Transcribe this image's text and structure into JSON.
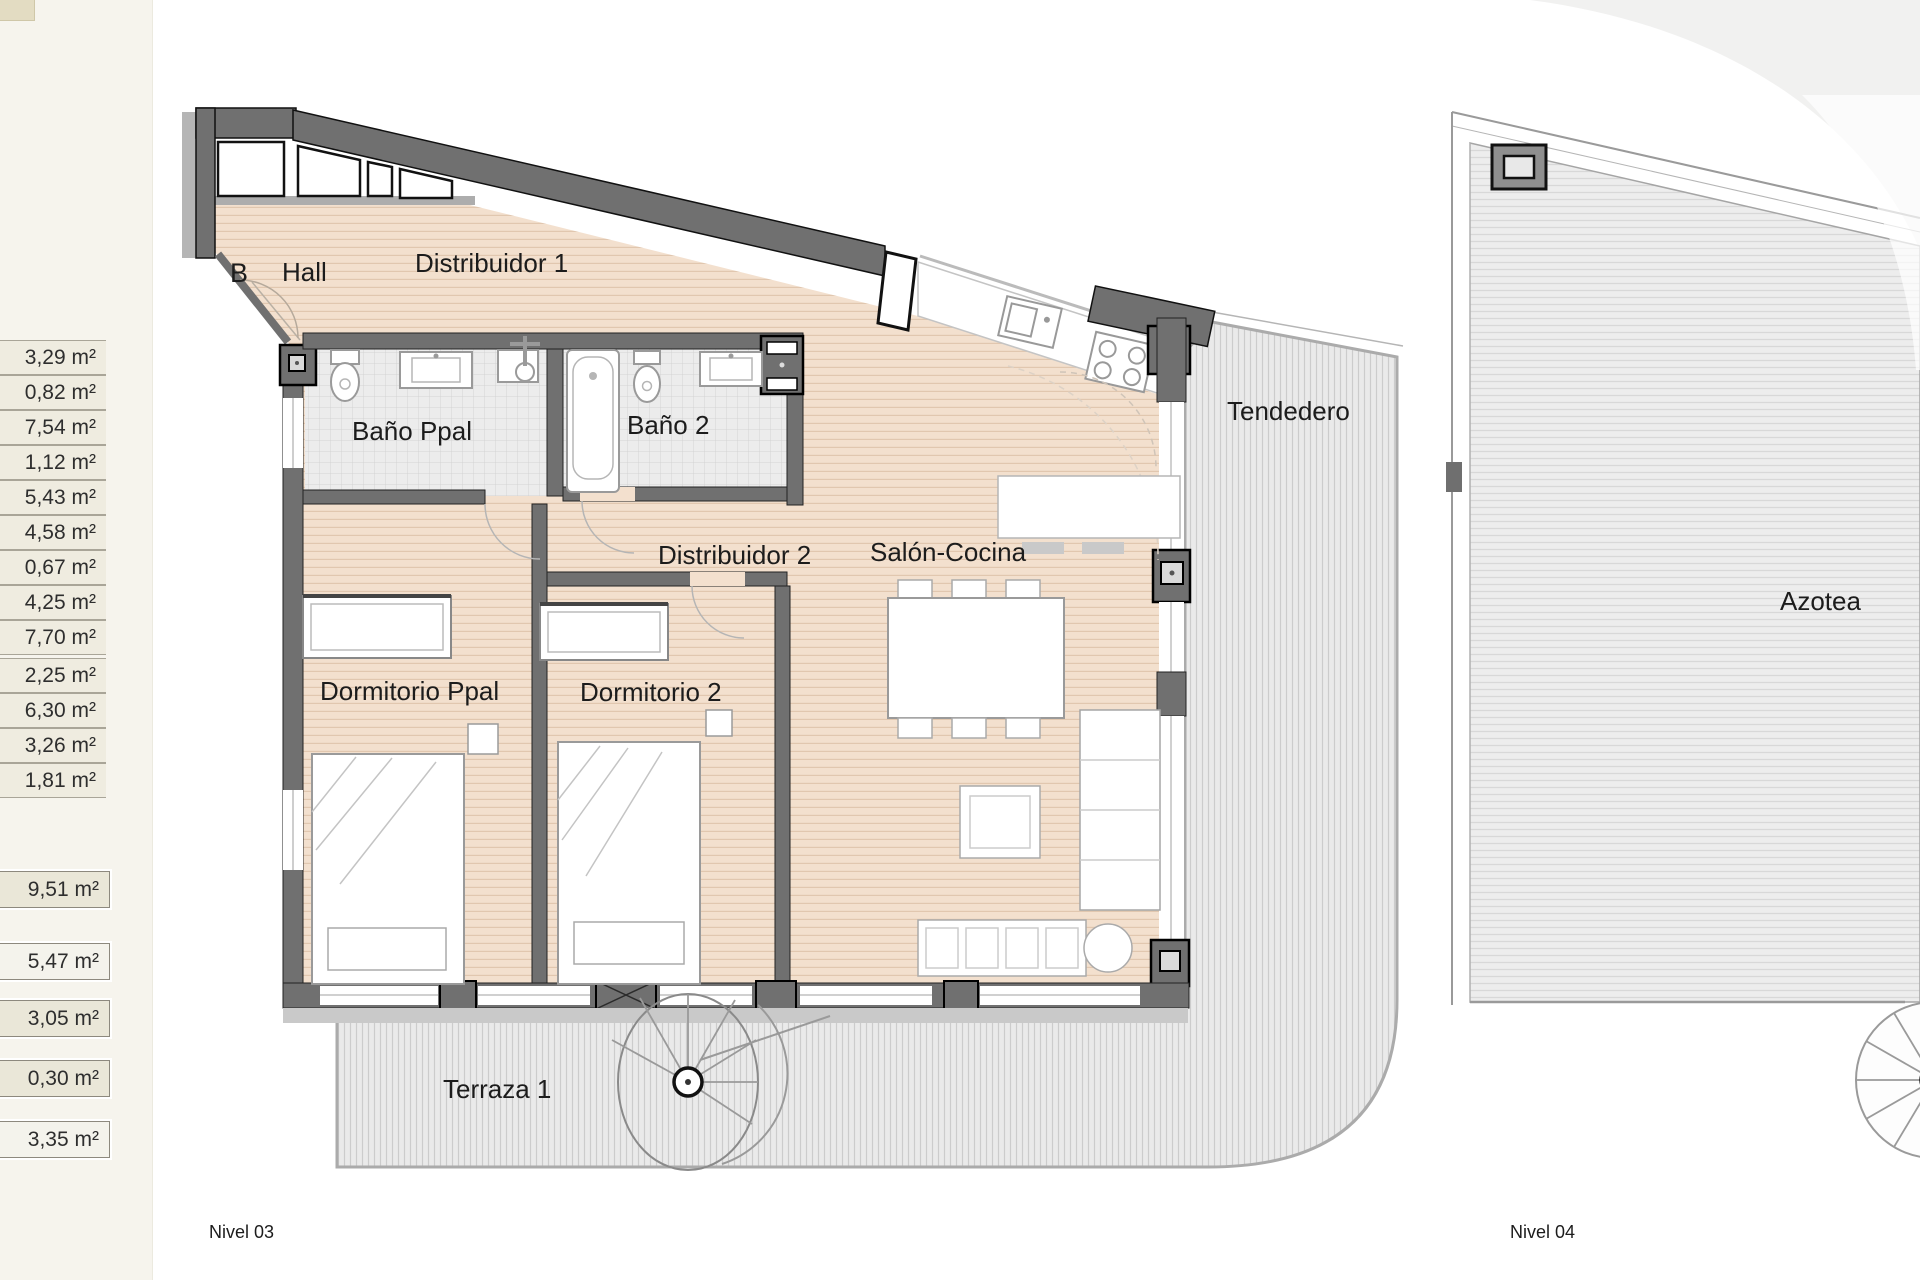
{
  "panel": {
    "rows_group1": [
      "3,29 m²",
      "0,82 m²",
      "7,54 m²",
      "1,12 m²",
      "5,43 m²",
      "4,58 m²",
      "0,67 m²",
      "4,25 m²",
      "7,70 m²"
    ],
    "rows_group2": [
      "2,25 m²",
      "6,30 m²",
      "3,26 m²",
      "1,81 m²"
    ],
    "totals": [
      "9,51 m²",
      "5,47 m²",
      "3,05 m²",
      "0,30 m²",
      "3,35 m²"
    ]
  },
  "plan_level3": {
    "unit_label": "B",
    "rooms": {
      "hall": "Hall",
      "distribuidor1": "Distribuidor 1",
      "banoPpal": "Baño Ppal",
      "bano2": "Baño 2",
      "distribuidor2": "Distribuidor 2",
      "salonCocina": "Salón-Cocina",
      "tendedero": "Tendedero",
      "dormitorioPpal": "Dormitorio Ppal",
      "dormitorio2": "Dormitorio 2",
      "terraza1": "Terraza 1"
    },
    "caption": "Nivel 03"
  },
  "plan_level4": {
    "rooms": {
      "azotea": "Azotea"
    },
    "caption": "Nivel 04"
  },
  "colors": {
    "wall": "#707070",
    "wood_floor": "#f3e0ce",
    "tile_floor": "#ececec",
    "outdoor_hatch": "#eaeaea",
    "unit_letter": "#8e3b2f"
  }
}
